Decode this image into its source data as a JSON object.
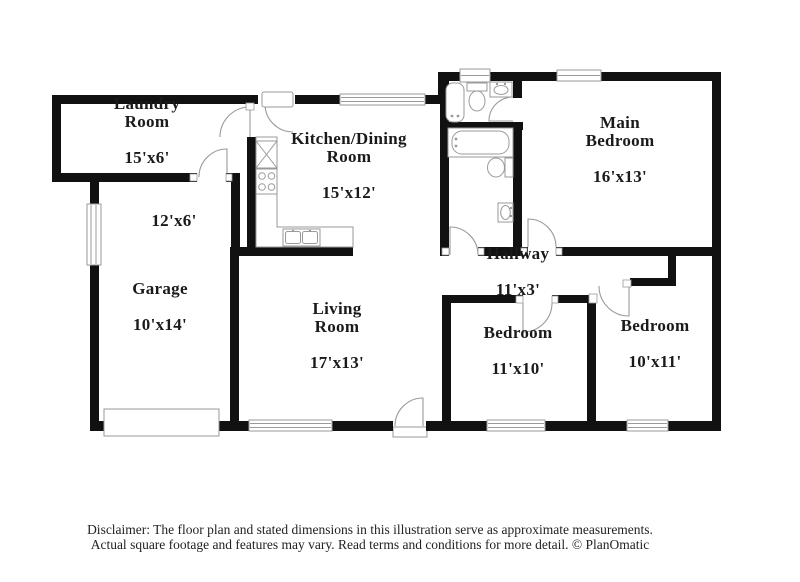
{
  "colors": {
    "wall": "#111111",
    "thin": "#9a9a9a",
    "label_text": "#1a1a1a",
    "disclaimer_text": "#222222",
    "background": "#ffffff"
  },
  "rooms": [
    {
      "name": "Laundry\nRoom",
      "dims": "15'x6'"
    },
    {
      "name": "",
      "dims": "12'x6'"
    },
    {
      "name": "Kitchen/Dining\nRoom",
      "dims": "15'x12'"
    },
    {
      "name": "Main\nBedroom",
      "dims": "16'x13'"
    },
    {
      "name": "Garage",
      "dims": "10'x14'"
    },
    {
      "name": "Living\nRoom",
      "dims": "17'x13'"
    },
    {
      "name": "Hallway",
      "dims": "11'x3'"
    },
    {
      "name": "Bedroom",
      "dims": "11'x10'"
    },
    {
      "name": "Bedroom",
      "dims": "10'x11'"
    }
  ],
  "disclaimer": {
    "line1": "Disclaimer: The floor plan and stated dimensions in this illustration serve as approximate measurements.",
    "line2": "Actual square footage and features may vary. Read terms and conditions for more detail. © PlanOmatic"
  }
}
